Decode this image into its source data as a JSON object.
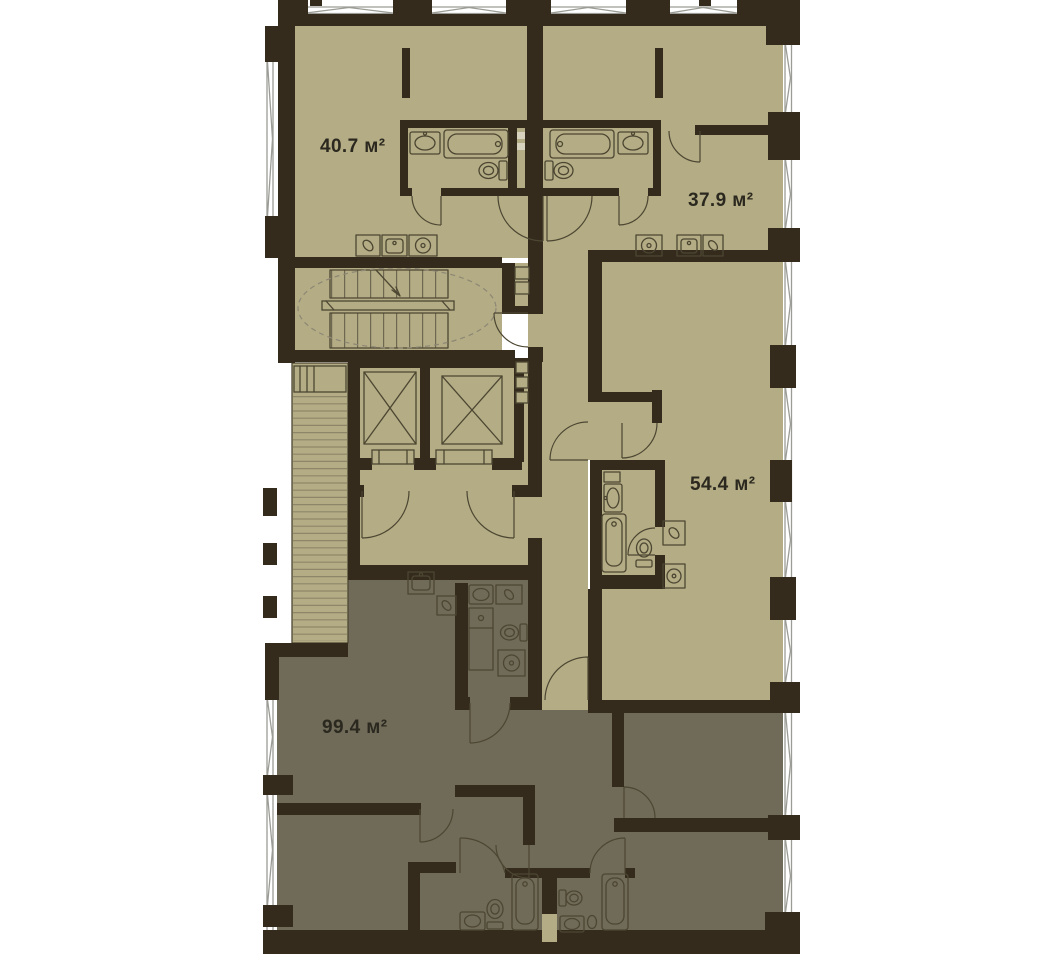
{
  "page": {
    "background": "#ffffff"
  },
  "plan": {
    "name": "Residential floor plan",
    "apartments": [
      {
        "id": "apt-1",
        "area_label": "40.7 м²"
      },
      {
        "id": "apt-2",
        "area_label": "37.9 м²"
      },
      {
        "id": "apt-3",
        "area_label": "54.4 м²"
      },
      {
        "id": "apt-4",
        "area_label": "99.4 м²"
      }
    ],
    "colors": {
      "wall": "#342b1d",
      "floor_light": "#b4ac84",
      "floor_dark": "#6f6b58",
      "fixture_line": "#4c4632",
      "window_line": "#9c9c96",
      "hatch_line": "#8d8668",
      "dashed_line": "#8d8775",
      "label_text": "#2b281f",
      "background": "#ffffff"
    },
    "icons": [
      "bathtub-icon",
      "toilet-icon",
      "sink-icon",
      "washing-machine-icon",
      "stove-icon",
      "kitchen-sink-icon",
      "cutting-board-icon",
      "staircase-icon",
      "elevator-icon",
      "door-arc-icon",
      "window-icon",
      "vent-shaft-icon"
    ]
  }
}
